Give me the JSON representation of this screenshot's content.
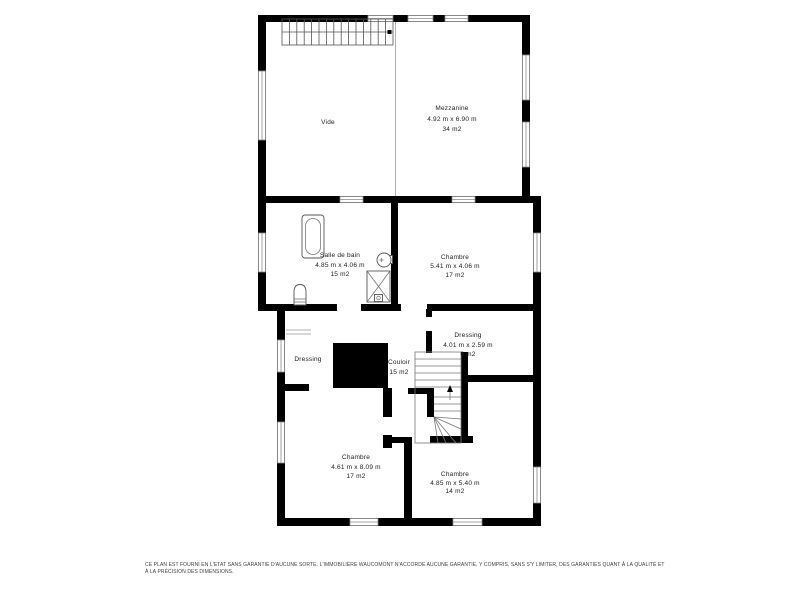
{
  "plan": {
    "title": "floor-plan-level",
    "colors": {
      "wall": "#000000",
      "window_outline": "#8a8a8a",
      "text": "#222222",
      "background": "#ffffff"
    },
    "rooms": {
      "vide": {
        "name": "Vide"
      },
      "mezzanine": {
        "name": "Mezzanine",
        "dimensions": "4.92 m x 6.90 m",
        "area": "34 m2"
      },
      "salle_de_bain": {
        "name": "Salle de bain",
        "dimensions": "4.85 m x 4.06 m",
        "area": "15 m2"
      },
      "chambre_1": {
        "name": "Chambre",
        "dimensions": "5.41 m x 4.06 m",
        "area": "17 m2"
      },
      "dressing_gauche": {
        "name": "Dressing"
      },
      "couloir": {
        "name": "Couloir",
        "area": "15 m2"
      },
      "dressing_droit": {
        "name": "Dressing",
        "dimensions": "4.01 m x 2.59 m",
        "area": "6 m2"
      },
      "chambre_2": {
        "name": "Chambre",
        "dimensions": "4.61 m x 8.09 m",
        "area": "17 m2"
      },
      "chambre_3": {
        "name": "Chambre",
        "dimensions": "4.85 m x 5.40 m",
        "area": "14 m2"
      }
    }
  },
  "footer": {
    "line1": "CE PLAN EST FOURNI EN L'ETAT SANS GARANTIE D'AUCUNE SORTE. L'IMMOBILIÈRE WAUCOMONT N'ACCORDE AUCUNE GARANTIE, Y COMPRIS, SANS S'Y LIMITER, DES GARANTIES QUANT À LA QUALITÉ ET",
    "line2": "À LA PRÉCISION DES DIMENSIONS."
  }
}
